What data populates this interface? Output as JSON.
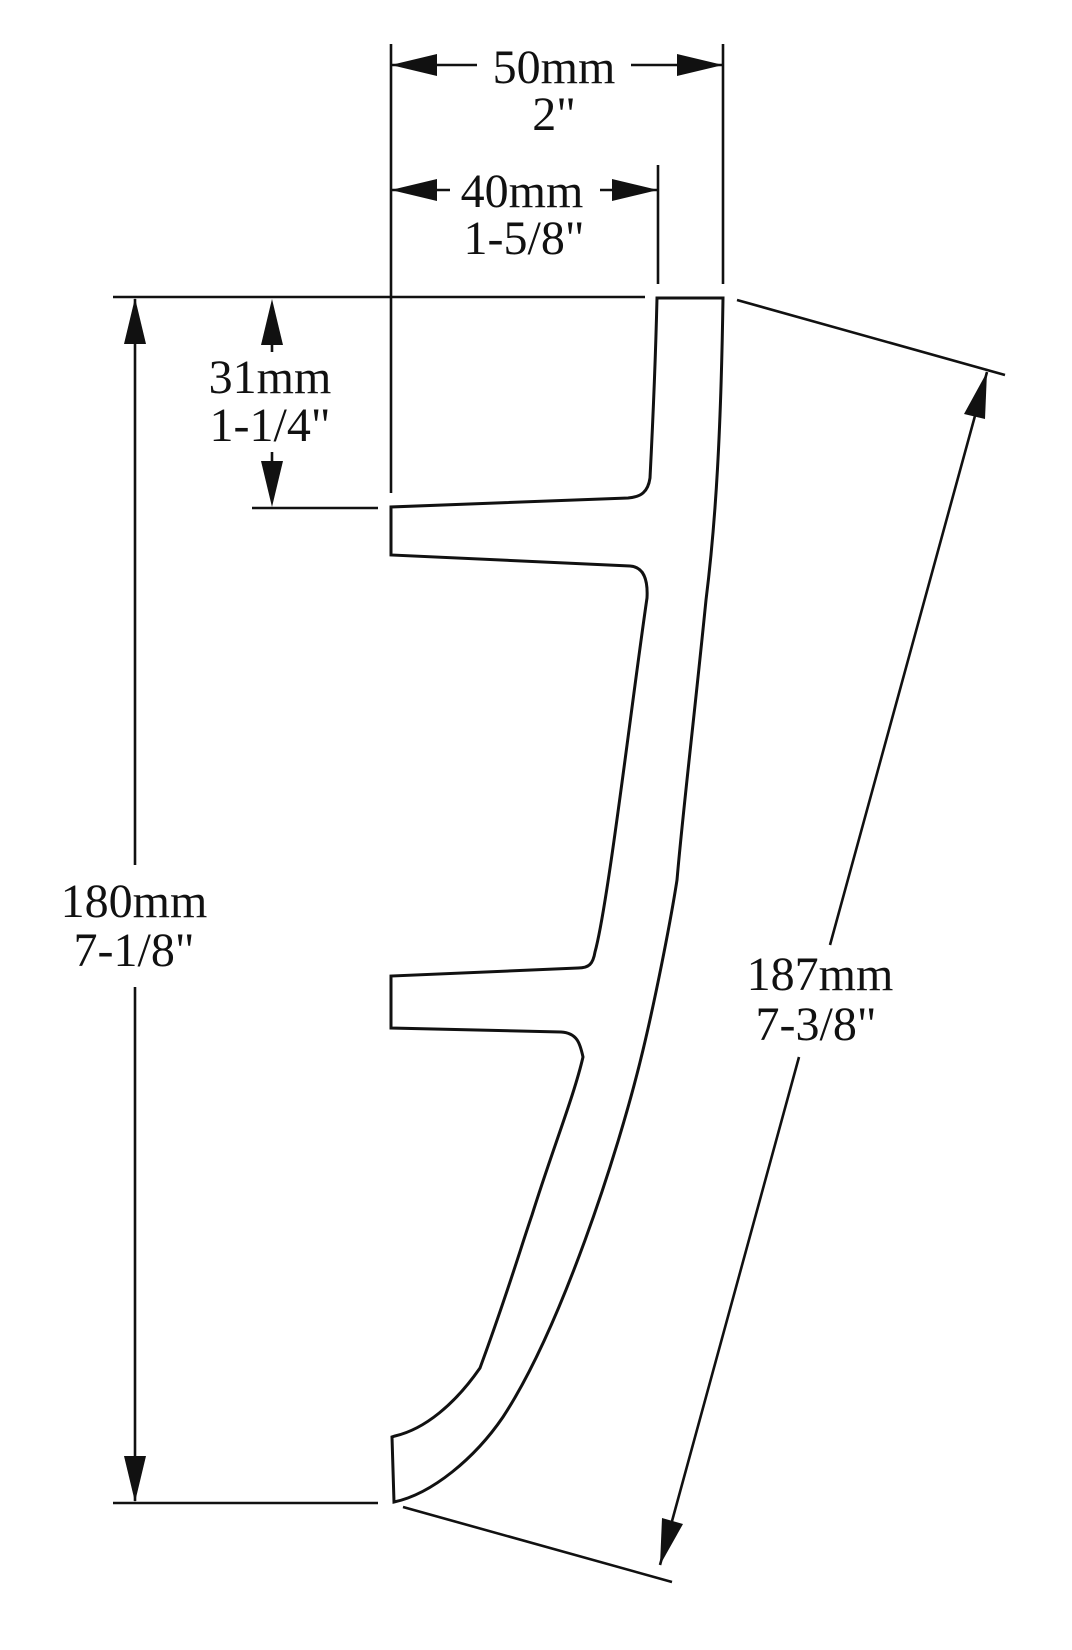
{
  "drawing": {
    "line_color": "#111111",
    "background_color": "#ffffff",
    "dims": {
      "d50": {
        "mm": "50mm",
        "inch": "2\""
      },
      "d40": {
        "mm": "40mm",
        "inch": "1-5/8\""
      },
      "d31": {
        "mm": "31mm",
        "inch": "1-1/4\""
      },
      "d180": {
        "mm": "180mm",
        "inch": "7-1/8\""
      },
      "d187": {
        "mm": "187mm",
        "inch": "7-3/8\""
      }
    }
  }
}
